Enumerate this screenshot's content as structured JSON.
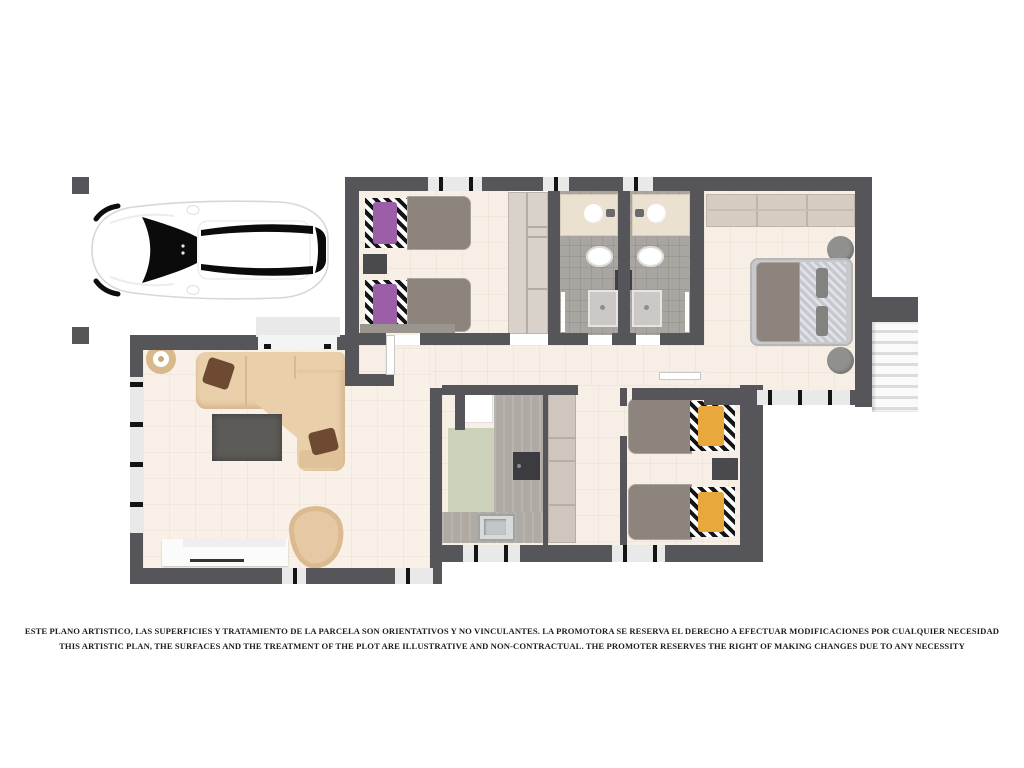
{
  "disclaimer": {
    "line_es": "ESTE PLANO ARTISTICO, LAS SUPERFICIES Y TRATAMIENTO DE LA PARCELA SON ORIENTATIVOS Y NO VINCULANTES. LA PROMOTORA SE RESERVA EL DERECHO A EFECTUAR MODIFICACIONES POR CUALQUIER NECESIDAD",
    "line_en": "THIS ARTISTIC PLAN, THE SURFACES AND THE TREATMENT OF THE PLOT ARE ILLUSTRATIVE AND NON-CONTRACTUAL. THE PROMOTER RESERVES THE RIGHT OF MAKING CHANGES DUE TO ANY NECESSITY"
  },
  "icons": [
    "car-top-view-icon",
    "single-bed-icon",
    "double-bed-icon",
    "sofa-sectional-icon",
    "armchair-icon",
    "rug-icon",
    "tv-sideboard-icon",
    "plant-table-icon",
    "wardrobe-icon",
    "sink-icon",
    "toilet-icon",
    "shower-icon",
    "kitchen-counter-icon",
    "cooktop-icon",
    "fridge-icon",
    "stairs-icon",
    "nightstand-icon",
    "pouf-icon",
    "window-icon",
    "door-icon"
  ],
  "colors": {
    "wall": "#55555a",
    "floor": "#f7efe6",
    "floor_warm": "#f9f1e8",
    "bath_floor": "#a9a5a0",
    "green_mat": "#ccd1ba",
    "wardrobe": "#d9d2ca",
    "wardrobe_line": "#b4ac a2",
    "master_wardrobe": "#d6ccc1",
    "counter": "#b0aaa4",
    "cabinet": "#cfc7bd",
    "cooktop": "#3c3c40",
    "sofa": "#eacfab",
    "sofa_line": "#d8b992",
    "pillow_brown": "#6e4a32",
    "rug": "#5d5b58",
    "armchair": "#e6c9a4",
    "tv": "#fbfbfb",
    "duvet": "#8d857d",
    "purple": "#9c5fa7",
    "yellow": "#e9a83b",
    "stripe_light": "#c5c8cf",
    "pouf": "#90908e",
    "nightstand": "#4a4a4e",
    "vanity": "#ebe1d1",
    "shower": "#cbc8c5",
    "window": "#e9e9e9",
    "tick": "#141414",
    "stairs": "#f4f4f4",
    "stair_edge": "#dcdcdc",
    "porch": "#e9e9e9",
    "car_glass": "#0b0b0b",
    "text": "#1d1d1d"
  }
}
